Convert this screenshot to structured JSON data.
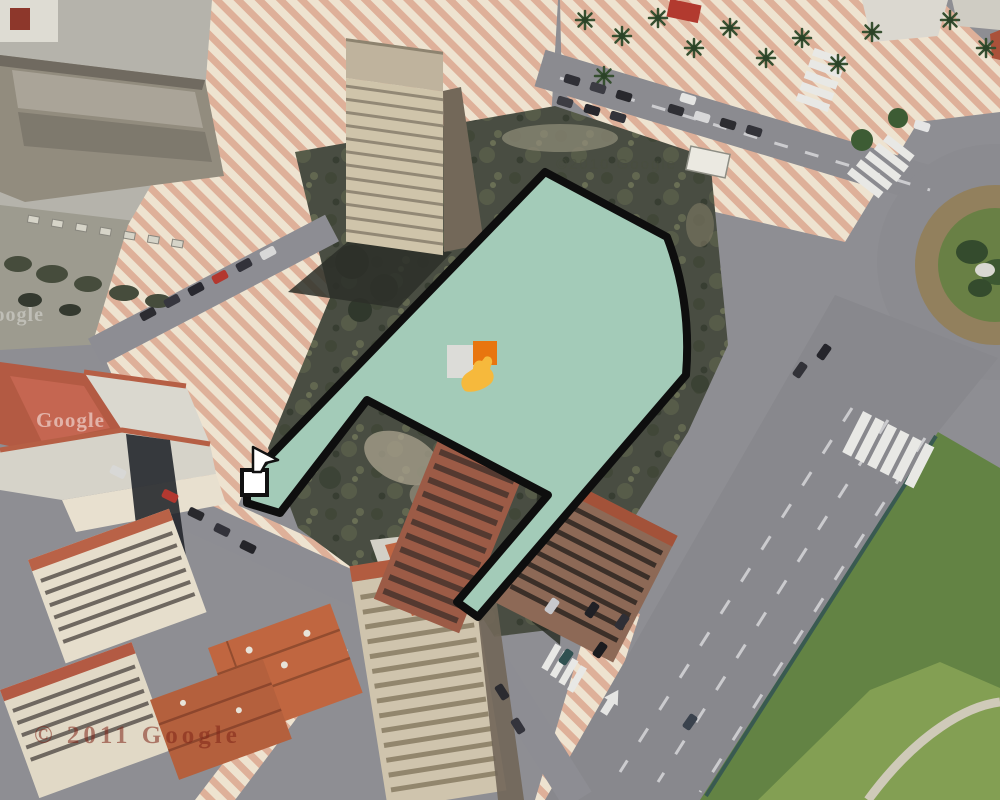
{
  "watermarks": {
    "top": "©2010 Google",
    "left": "Google",
    "left_partial": "Google",
    "bottom": "© 2011 Google"
  },
  "overlay": {
    "description": "selected-parcel-polygon",
    "fill": "#a3cbb8",
    "fill_opacity": 1,
    "stroke": "#0e0e0e",
    "stroke_width": 8,
    "path": "M545,172 L667,237 Q692,302 686,375 L478,617 L457,602 L548,495 L367,400 L280,513 L247,503 L247,480 Z",
    "vertex_handle": {
      "x": 242,
      "y": 470,
      "size": 25,
      "fill": "#ffffff",
      "stroke": "#111111",
      "stroke_width": 4
    },
    "cursor": {
      "x": 251,
      "y": 447
    },
    "markers": {
      "gray_square": {
        "x": 447,
        "y": 345,
        "w": 27,
        "h": 33,
        "color": "#dcdcd8"
      },
      "orange_square": {
        "x": 473,
        "y": 341,
        "w": 24,
        "h": 24,
        "color": "#e8750f"
      },
      "yellow_hand": {
        "x": 459,
        "y": 357,
        "color": "#f6b93c"
      }
    }
  },
  "scene_colors": {
    "stripe_pink": "#dfae96",
    "stripe_cream": "#f0e4d0",
    "asphalt": "#8b8b90",
    "scrub": "#42463a",
    "grass_verge": "#5d7f3d",
    "roof_terracotta": "#b5593e",
    "roundabout_dirt": "#8f7c57",
    "roundabout_green": "#647c3e"
  }
}
